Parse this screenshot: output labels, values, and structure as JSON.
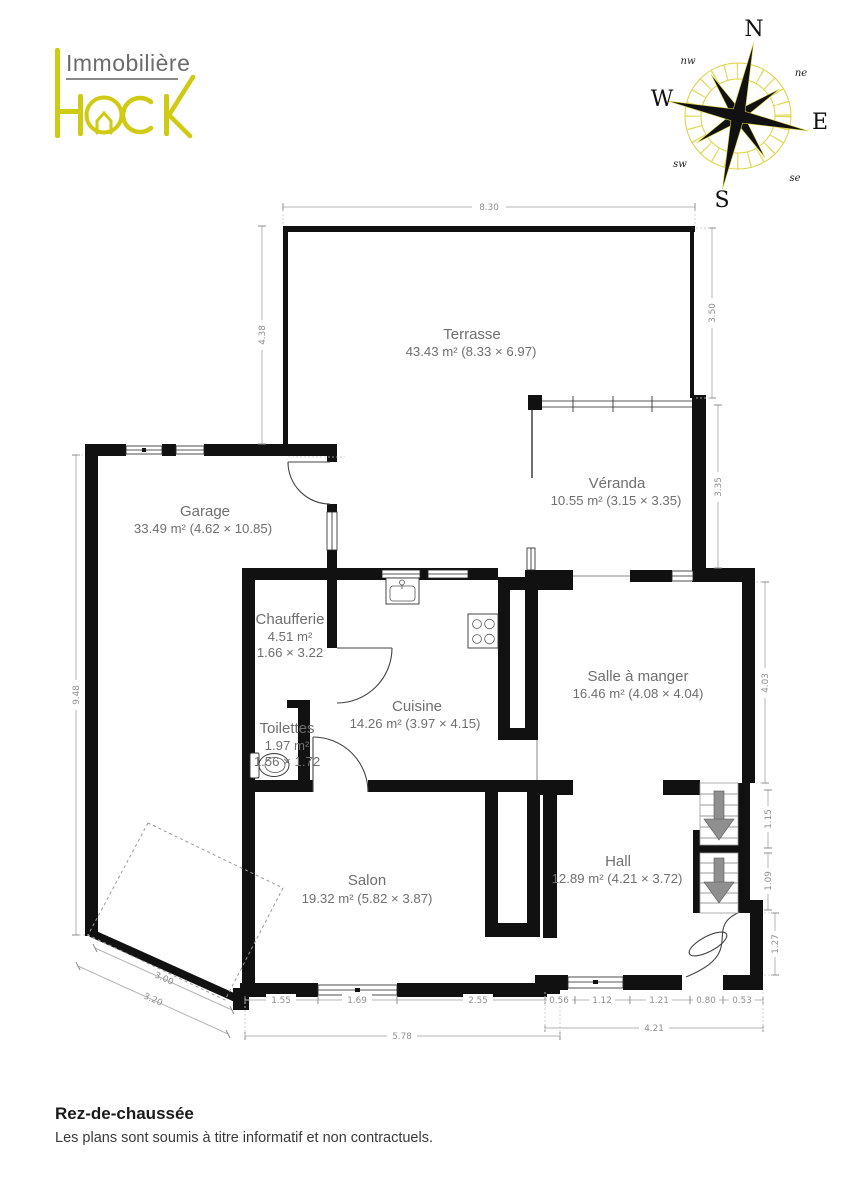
{
  "logo": {
    "line1": "Immobilière",
    "brand_part1": "H",
    "brand_part2": "CK",
    "brand_full": "HACK"
  },
  "compass": {
    "north": "N",
    "east": "E",
    "south": "S",
    "west": "W",
    "northwest": "nw",
    "northeast": "ne",
    "southwest": "sw",
    "southeast": "se"
  },
  "rooms": {
    "terrasse": {
      "name": "Terrasse",
      "size": "43.43 m² (8.33 × 6.97)"
    },
    "veranda": {
      "name": "Véranda",
      "size": "10.55 m² (3.15 × 3.35)"
    },
    "garage": {
      "name": "Garage",
      "size": "33.49 m² (4.62 × 10.85)"
    },
    "chaufferie": {
      "name": "Chaufferie",
      "area": "4.51 m²",
      "dims": "1.66 × 3.22"
    },
    "toilettes": {
      "name": "Toilettes",
      "area": "1.97 m²",
      "dims": "1.56 × 1.72"
    },
    "cuisine": {
      "name": "Cuisine",
      "size": "14.26 m² (3.97 × 4.15)"
    },
    "salle_a_manger": {
      "name": "Salle à manger",
      "size": "16.46 m² (4.08 × 4.04)"
    },
    "salon": {
      "name": "Salon",
      "size": "19.32 m² (5.82 × 3.87)"
    },
    "hall": {
      "name": "Hall",
      "size": "12.89 m² (4.21 × 3.72)"
    }
  },
  "dims": {
    "terrasse_width": "8.30",
    "terrasse_left_height": "4.38",
    "terrasse_right_height": "3.50",
    "veranda_right_height": "3.35",
    "salle_right_height": "4.03",
    "garage_left_height": "9.48",
    "stair_upper": "1.15",
    "stair_lower": "1.09",
    "entry_right": "1.27",
    "driveway_inner": "3.00",
    "driveway_outer": "3.20",
    "salon_seg1": "1.55",
    "salon_seg2": "1.69",
    "salon_seg3": "2.55",
    "salon_total": "5.78",
    "hall_seg1": "0.56",
    "hall_seg2": "1.12",
    "hall_seg3": "1.21",
    "hall_seg4": "0.80",
    "hall_seg5": "0.53",
    "hall_total": "4.21"
  },
  "footer": {
    "title": "Rez-de-chaussée",
    "disclaimer": "Les plans sont soumis à titre informatif et non contractuels."
  },
  "colors": {
    "accent_yellow": "#cfca12",
    "wall_black": "#111111",
    "room_label_gray": "#6f6f6f",
    "dim_gray": "#8f8f8f",
    "stair_arrow_gray": "#8f8f8f"
  }
}
